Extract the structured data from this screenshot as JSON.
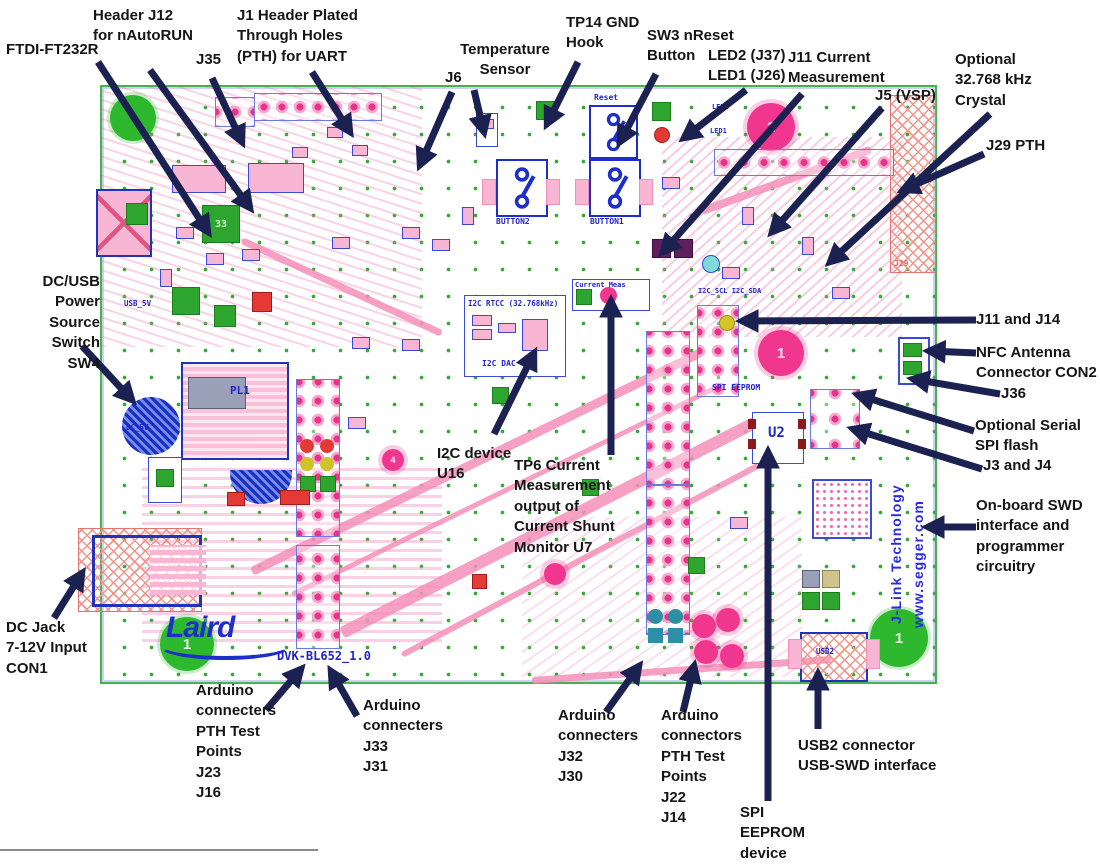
{
  "figure": {
    "board_name": "DVK-BL652_1.0",
    "description": "Annotated PCB layout of DVK-BL652 development kit"
  },
  "annotations": {
    "header_j12": {
      "text": "Header J12\nfor nAutoRUN"
    },
    "ftdi": {
      "text": "FTDI-FT232R"
    },
    "j1_header": {
      "text": "J1 Header Plated\nThrough Holes\n(PTH) for UART"
    },
    "j35": {
      "text": "J35"
    },
    "temp_sensor": {
      "text": "Temperature\nSensor"
    },
    "j6": {
      "text": "J6"
    },
    "tp14": {
      "text": "TP14 GND\nHook"
    },
    "sw3": {
      "text": "SW3 nReset\nButton"
    },
    "leds": {
      "text": "LED2 (J37)\nLED1 (J26)"
    },
    "j11_current": {
      "text": "J11 Current\nMeasurement"
    },
    "j5_vsp": {
      "text": "J5 (VSP)"
    },
    "crystal": {
      "text": "Optional\n32.768 kHz\nCrystal"
    },
    "j29": {
      "text": "J29 PTH"
    },
    "sw4": {
      "text": "DC/USB\nPower\nSource\nSwitch\nSW4"
    },
    "j11_j14": {
      "text": "J11 and J14"
    },
    "nfc": {
      "text": "NFC Antenna\nConnector CON2"
    },
    "j36": {
      "text": "J36"
    },
    "spi_flash": {
      "text": "Optional Serial\nSPI flash"
    },
    "j3_j4": {
      "text": "J3 and J4"
    },
    "swd": {
      "text": "On-board SWD\ninterface and\nprogrammer\ncircuitry"
    },
    "i2c_u16": {
      "text": "I2C device\nU16"
    },
    "tp6": {
      "text": "TP6 Current\nMeasurement\noutput of\nCurrent Shunt\nMonitor U7"
    },
    "dc_jack": {
      "text": "DC Jack\n7-12V Input\nCON1"
    },
    "ard_j23": {
      "text": "Arduino\nconnecters\nPTH Test\nPoints\nJ23\nJ16"
    },
    "ard_j33": {
      "text": "Arduino\nconnecters\nJ33\nJ31"
    },
    "ard_j32": {
      "text": "Arduino\nconnecters\nJ32\nJ30"
    },
    "ard_j22": {
      "text": "Arduino\nconnectors\nPTH Test\nPoints\nJ22\nJ14"
    },
    "spi_eeprom": {
      "text": "SPI\nEEPROM\ndevice"
    },
    "usb2": {
      "text": "USB2 connector\nUSB-SWD interface"
    }
  },
  "silkscreen": {
    "laird": "Laird",
    "version": "DVK-BL652_1.0",
    "button1": "BUTTON1",
    "button2": "BUTTON2",
    "reset": "Reset",
    "i2c_rtcc": "I2C RTCC (32.768kHz)",
    "i2c_dac": "I2C DAC",
    "current_meas": "Current Meas",
    "spi_eeprom_silk": "SPI EEPROM",
    "u2": "U2",
    "usb2_silk": "USB2",
    "jlink": "J-Link Technology",
    "segger": "www.segger.com",
    "dc_5v": "DC_5V",
    "usb_5v": "USB_5V",
    "i2c_pins": "I2C_SCL  I2C_SDA",
    "pl1": "PL1",
    "led1": "LED1",
    "led2": "LED2",
    "j29_silk": "J29",
    "fid1": "1"
  },
  "colors": {
    "arrow": "#1b2150",
    "silkscreen_blue": "#2323cc",
    "board_green": "#4ab04a",
    "pad_pink": "#e8338a",
    "copper_pink": "#f48fb8",
    "hatch_red": "#f1948a",
    "annotation_text": "#151515"
  }
}
